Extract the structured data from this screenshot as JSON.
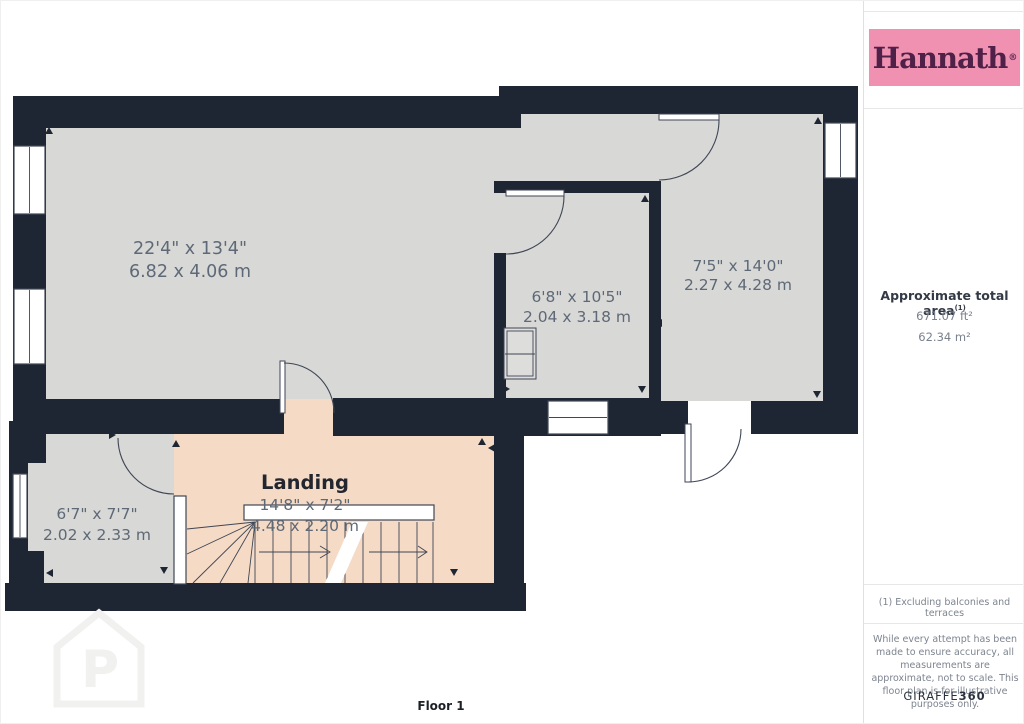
{
  "branding": {
    "agency_logo_text": "Hannath",
    "agency_logo_registered": "®",
    "provider_name_regular": "GIRAFFE",
    "provider_name_bold": "360"
  },
  "sidebar": {
    "area": {
      "title": "Approximate total area",
      "title_superscript": "(1)",
      "value_imperial": "671.07 ft²",
      "value_metric": "62.34 m²"
    },
    "footnote": "(1) Excluding balconies and terraces",
    "disclaimer": "While every attempt has been made to ensure accuracy, all measurements are approximate, not to scale. This floor plan is for illustrative purposes only."
  },
  "floor_plan": {
    "floor_label": "Floor 1",
    "rooms": [
      {
        "name": "",
        "imperial": "22'4\" x 13'4\"",
        "metric": "6.82 x 4.06 m"
      },
      {
        "name": "",
        "imperial": "6'8\" x 10'5\"",
        "metric": "2.04 x 3.18 m"
      },
      {
        "name": "",
        "imperial": "7'5\" x 14'0\"",
        "metric": "2.27 x 4.28 m"
      },
      {
        "name": "Landing",
        "imperial": "14'8\" x 7'2\"",
        "metric": "4.48 x 2.20 m"
      },
      {
        "name": "",
        "imperial": "6'7\" x 7'7\"",
        "metric": "2.02 x 2.33 m"
      }
    ],
    "colors": {
      "wall": "#1e2634",
      "room_fill": "#d8d8d6",
      "landing_fill": "#f5dac6",
      "dimension_text": "#5e6977",
      "brand_pink": "#f091b1",
      "brand_plum": "#4f2148"
    }
  }
}
